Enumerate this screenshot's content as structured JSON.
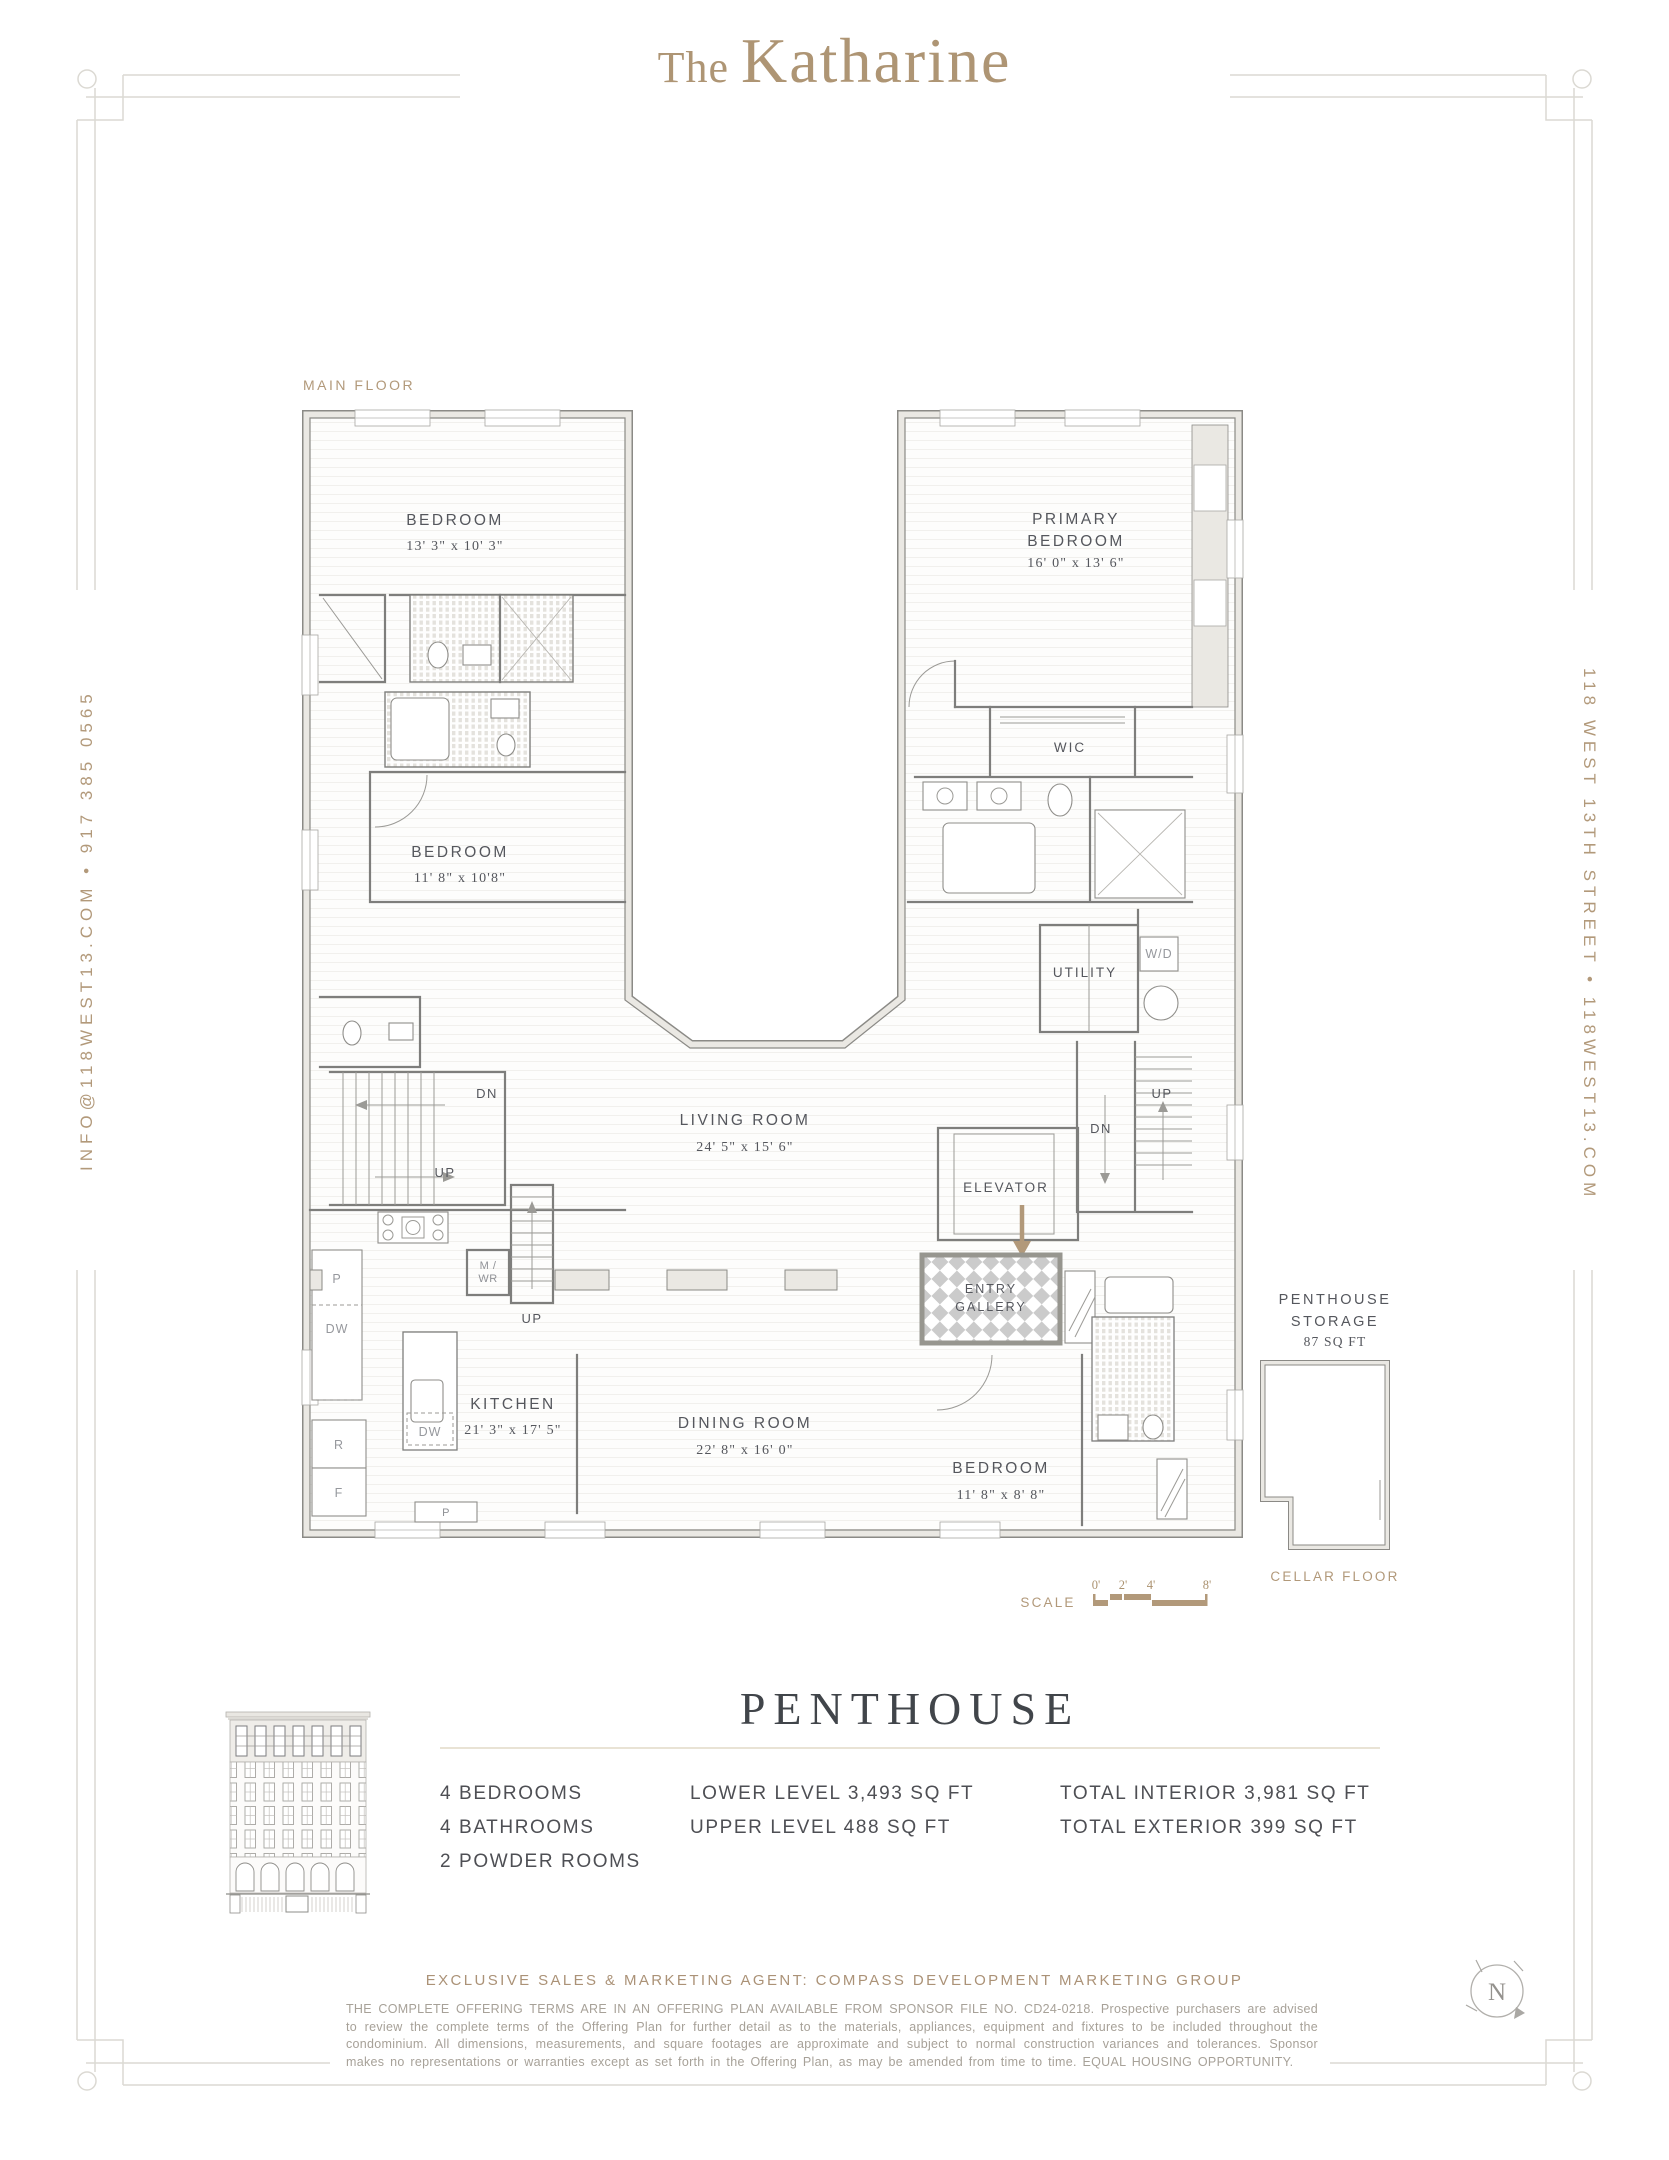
{
  "page": {
    "title_prefix": "The",
    "title_name": "Katharine",
    "side_left": "INFO@118WEST13.COM  •  917 385 0565",
    "side_right": "118 WEST 13TH STREET  •  118WEST13.COM"
  },
  "plan": {
    "floor_label": "MAIN FLOOR",
    "bedroom1": {
      "name": "BEDROOM",
      "dims": "13' 3\" x 10' 3\""
    },
    "bedroom2": {
      "name": "BEDROOM",
      "dims": "11' 8\" x 10'8\""
    },
    "bedroom3": {
      "name": "BEDROOM",
      "dims": "11' 8\" x 8' 8\""
    },
    "primary": {
      "line1": "PRIMARY",
      "line2": "BEDROOM",
      "dims": "16' 0\" x 13' 6\""
    },
    "wic": "WIC",
    "utility": "UTILITY",
    "wd": "W/D",
    "mwr1": "M /",
    "mwr2": "WR",
    "living": {
      "name": "LIVING ROOM",
      "dims": "24' 5\" x 15' 6\""
    },
    "dining": {
      "name": "DINING ROOM",
      "dims": "22' 8\" x 16' 0\""
    },
    "kitchen": {
      "name": "KITCHEN",
      "dims": "21' 3\" x 17' 5\""
    },
    "elevator": "ELEVATOR",
    "entry1": "ENTRY",
    "entry2": "GALLERY",
    "dn_left": "DN",
    "up_left": "UP",
    "up_kitchen": "UP",
    "up_right": "UP",
    "dn_right": "DN",
    "p1": "P",
    "dw1": "DW",
    "r1": "R",
    "f1": "F",
    "dw_island": "DW",
    "p2": "P",
    "storage_1": "PENTHOUSE",
    "storage_2": "STORAGE",
    "storage_area": "87 SQ FT",
    "cellar": "CELLAR FLOOR",
    "scale_label": "SCALE",
    "scale_0": "0'",
    "scale_2": "2'",
    "scale_4": "4'",
    "scale_8": "8'"
  },
  "summary": {
    "title": "PENTHOUSE",
    "rooms": [
      "4 BEDROOMS",
      "4 BATHROOMS",
      "2 POWDER ROOMS"
    ],
    "levels": [
      "LOWER LEVEL 3,493 SQ FT",
      "UPPER LEVEL 488 SQ FT"
    ],
    "totals": [
      "TOTAL INTERIOR 3,981 SQ FT",
      "TOTAL EXTERIOR 399 SQ FT"
    ]
  },
  "footer": {
    "agent": "EXCLUSIVE SALES & MARKETING AGENT: COMPASS DEVELOPMENT MARKETING GROUP",
    "disclaimer": "THE COMPLETE OFFERING TERMS ARE IN AN OFFERING PLAN AVAILABLE FROM SPONSOR FILE NO. CD24-0218. Prospective purchasers are advised to review the complete terms of the Offering Plan for further detail as to the materials, appliances, equipment and fixtures to be included throughout the condominium. All dimensions, measurements, and square footages are approximate and subject to normal construction variances and tolerances. Sponsor makes no representations or warranties except as set forth in the Offering Plan, as may be amended from time to time. EQUAL HOUSING OPPORTUNITY.",
    "north": "N"
  }
}
